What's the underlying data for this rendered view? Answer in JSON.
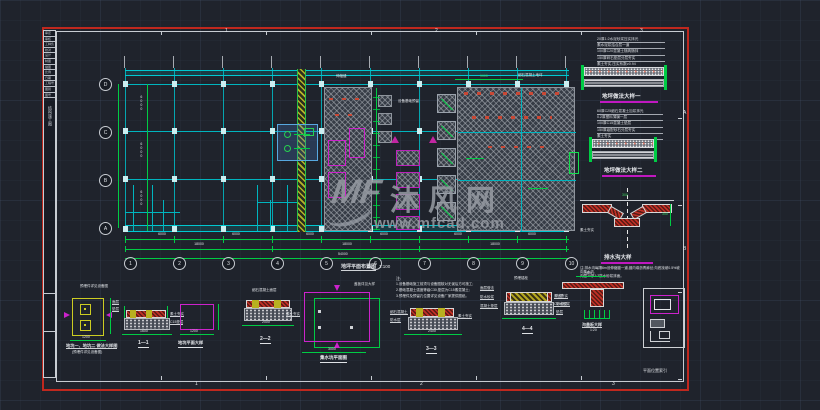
{
  "watermark": {
    "logo_text": "MF",
    "site_name": "沐风网",
    "site_url": "www.mfcad.com"
  },
  "sheet": {
    "zone_numbers_top": [
      "1",
      "2",
      "3"
    ],
    "zone_numbers_bottom": [
      "1",
      "2",
      "3"
    ],
    "zone_letters_right": [
      "A",
      "B"
    ],
    "titleblock_rows": [
      "审定",
      "审核",
      "工种负责",
      "校对",
      "设计",
      "制图",
      "描图",
      "比例",
      "日期",
      "工程号",
      "图别",
      "图号"
    ],
    "titleblock_label": "结构施工图"
  },
  "plan": {
    "title": "地坪平面布置图",
    "scale": "1:100",
    "axes_bottom": [
      "1",
      "2",
      "3",
      "4",
      "5",
      "6",
      "7",
      "8",
      "9",
      "10"
    ],
    "axes_left": [
      "D",
      "C",
      "B",
      "A"
    ],
    "dims_bottom_row1": [
      "6000",
      "6000",
      "6000",
      "6000",
      "6000",
      "6000"
    ],
    "dims_bottom_row2": [
      "18000",
      "18000",
      "18000"
    ],
    "dim_total": "54000",
    "dims_left": [
      "6000",
      "6000",
      "6000"
    ],
    "leader_joint": "伸缩缝",
    "leader_floor": "细石混凝土地坪",
    "leader_equipment": "设备基础预留",
    "dim_top_right": "9000"
  },
  "right_column": {
    "notes_a": [
      "20厚1:2水泥砂浆压实抹光",
      "素水泥浆结合层一道",
      "100厚C20混凝土随捣随抹",
      "150厚碎石垫层分层夯实",
      "素土夯实,压实系数≥0.94"
    ],
    "detail_a_title": "地坪做法大样一",
    "notes_b": [
      "60厚C25细石混凝土加浆抹光",
      "0.2厚塑料薄膜一层",
      "100厚C15混凝土垫层",
      "150厚级配砂石分层夯实",
      "素土夯实"
    ],
    "detail_b_title": "地坪做法大样二",
    "drain_dim_width": "300",
    "drain_dim_depth": "300",
    "drain_label_left": "素土夯实",
    "drain_title": "排水沟大样",
    "drain_note_1": "注:排水沟每隔6m设伸缩缝一道,缝内填沥青麻丝;沟底找坡0.5%坡向集水坑,",
    "drain_note_2": "内壁20厚1:2防水砂浆抹面。"
  },
  "details": {
    "a": {
      "leader": "预埋件详见设备图",
      "dim": "1200",
      "title1": "地坑一、地坑二 做法大样图",
      "title2": "(预埋件详见设备图)"
    },
    "b": {
      "label_left_1": "面层",
      "label_left_2": "垫层",
      "label_right_1": "素土夯实",
      "label_right_2": "C15垫层",
      "dim": "1600",
      "title": "1—1"
    },
    "c": {
      "dim_w": "1200",
      "dim_h": "800",
      "title": "地坑平面大样"
    },
    "d": {
      "leader": "细石混凝土面层",
      "label_right": "素土夯实",
      "dim": "2000",
      "title": "2—2"
    },
    "e": {
      "leader": "盖板详见大样",
      "dim": "3000",
      "title": "集水坑平面图"
    },
    "f": {
      "note_title": "注:",
      "note_1": "1.设备基础施工前须与设备图核对无误后方可施工;",
      "note_2": "2.基础混凝土强度等级C30,垫层为C15素混凝土;",
      "note_3": "3.预埋件及预留孔位置详见设备厂家提供图纸。",
      "label_left_1": "细石混凝土",
      "label_left_2": "防水层",
      "label_right": "素土夯实",
      "dim": "2400",
      "title": "3—3"
    },
    "g": {
      "leader_top": "预埋锚栓",
      "label_left_1": "面层做法",
      "label_left_2": "防水砂浆",
      "label_left_3": "混凝土垫层",
      "label_right_1": "素土夯实",
      "label_right_2": "C15垫层",
      "title": "4—4"
    },
    "h": {
      "dim_top": "400",
      "label_left_1": "沟壁",
      "label_left_2": "防水砂浆",
      "label_left_3": "垫层",
      "title1": "沟盖板大样",
      "title2": "1:20"
    },
    "keyplan_label": "平面位置索引"
  }
}
